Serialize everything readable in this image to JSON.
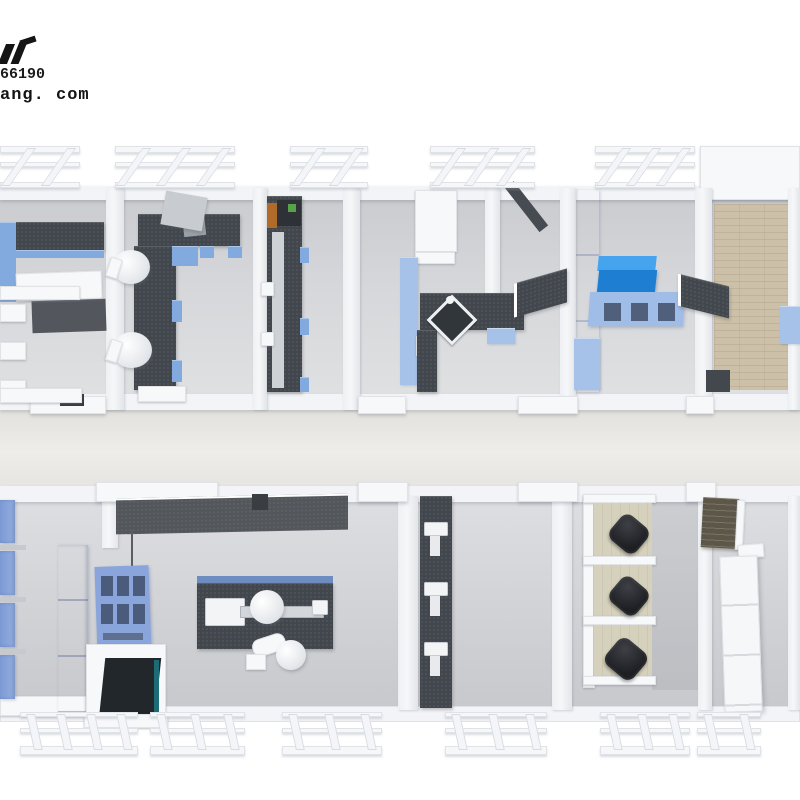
{
  "watermark": {
    "phone_fragment": "66190",
    "website_fragment": "ang. com"
  },
  "scene": {
    "type": "floor-plan-render",
    "view": "top-down"
  },
  "palette": {
    "background": "#ffffff",
    "wall_white": "#f3f4f7",
    "floor_gray": "#d5d6d9",
    "corridor": "#eae8e4",
    "bench_dark": "#42474d",
    "accent_blue": "#82aade",
    "cabinet_blue": "#7d9ad6",
    "pale_blue": "#a7c2e8",
    "vivid_blue_front": "#1e7ed2",
    "vivid_blue_top": "#46a4ee",
    "wood_floor": "#ccc0a8",
    "dark_wood": "#5d574a",
    "desk_beige": "#d5d1bc",
    "chair_black": "#25262a",
    "teal_accent": "#1d6b74"
  }
}
